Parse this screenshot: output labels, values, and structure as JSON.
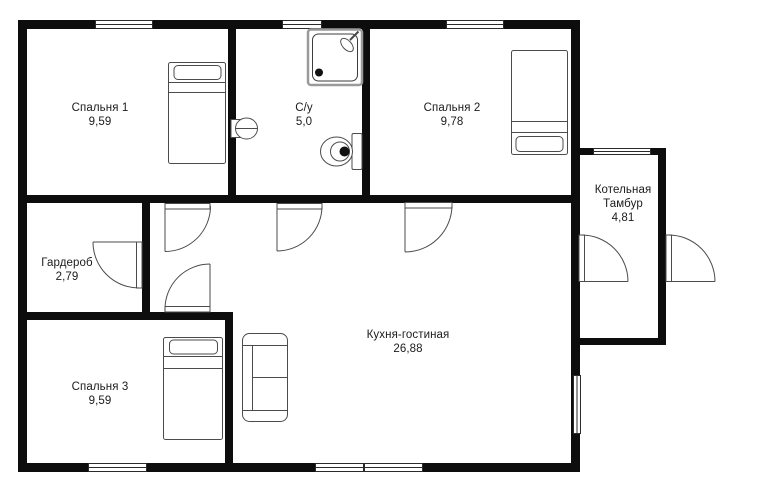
{
  "plan": {
    "rooms": [
      {
        "name": "Спальня 1",
        "area": "9,59"
      },
      {
        "name": "С/у",
        "area": "5,0"
      },
      {
        "name": "Спальня 2",
        "area": "9,78"
      },
      {
        "name": "Котельная",
        "name2": "Тамбур",
        "area": "4,81"
      },
      {
        "name": "Гардероб",
        "area": "2,79"
      },
      {
        "name": "Кухня-гостиная",
        "area": "26,88"
      },
      {
        "name": "Спальня 3",
        "area": "9,59"
      }
    ],
    "icons": [
      "window-icon",
      "door-swing-icon",
      "bed-icon",
      "sofa-icon",
      "shower-icon",
      "toilet-icon",
      "sink-icon"
    ],
    "colors": {
      "wall": "#0d0d0d",
      "outline": "#4b4b4b",
      "text": "#1b1b1b",
      "background": "#ffffff"
    }
  }
}
